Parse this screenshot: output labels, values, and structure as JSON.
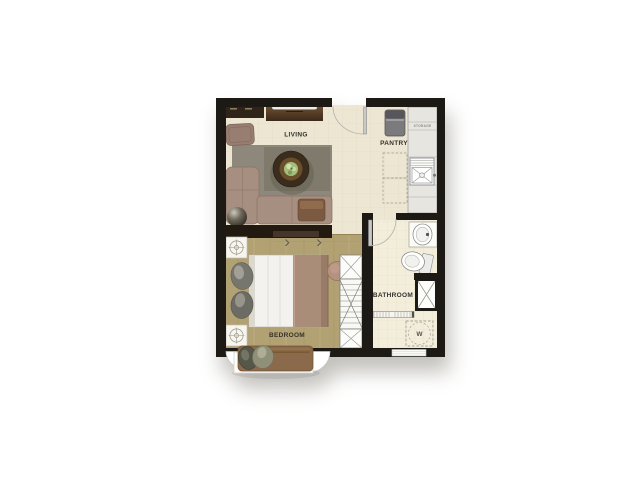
{
  "plan": {
    "type": "apartment-floor-plan",
    "rooms": {
      "living": {
        "label": "LIVING"
      },
      "pantry": {
        "label": "PANTRY"
      },
      "bedroom": {
        "label": "BEDROOM"
      },
      "bathroom": {
        "label": "BATHROOM"
      }
    },
    "annotations": {
      "storage": {
        "label": "STORAGE"
      },
      "washer": {
        "label": "W"
      }
    },
    "colors": {
      "wall": "#1d1a16",
      "floor_main": "#ece6d3",
      "floor_wood": "#b2a173",
      "floor_tile": "#f3eedb",
      "rug": "#8d887b",
      "sofa": "#a68e80",
      "bed_blanket": "#aa8d79",
      "bench": "#8a6a4a",
      "counter": "#e6e5e0",
      "background": "#ffffff"
    }
  }
}
